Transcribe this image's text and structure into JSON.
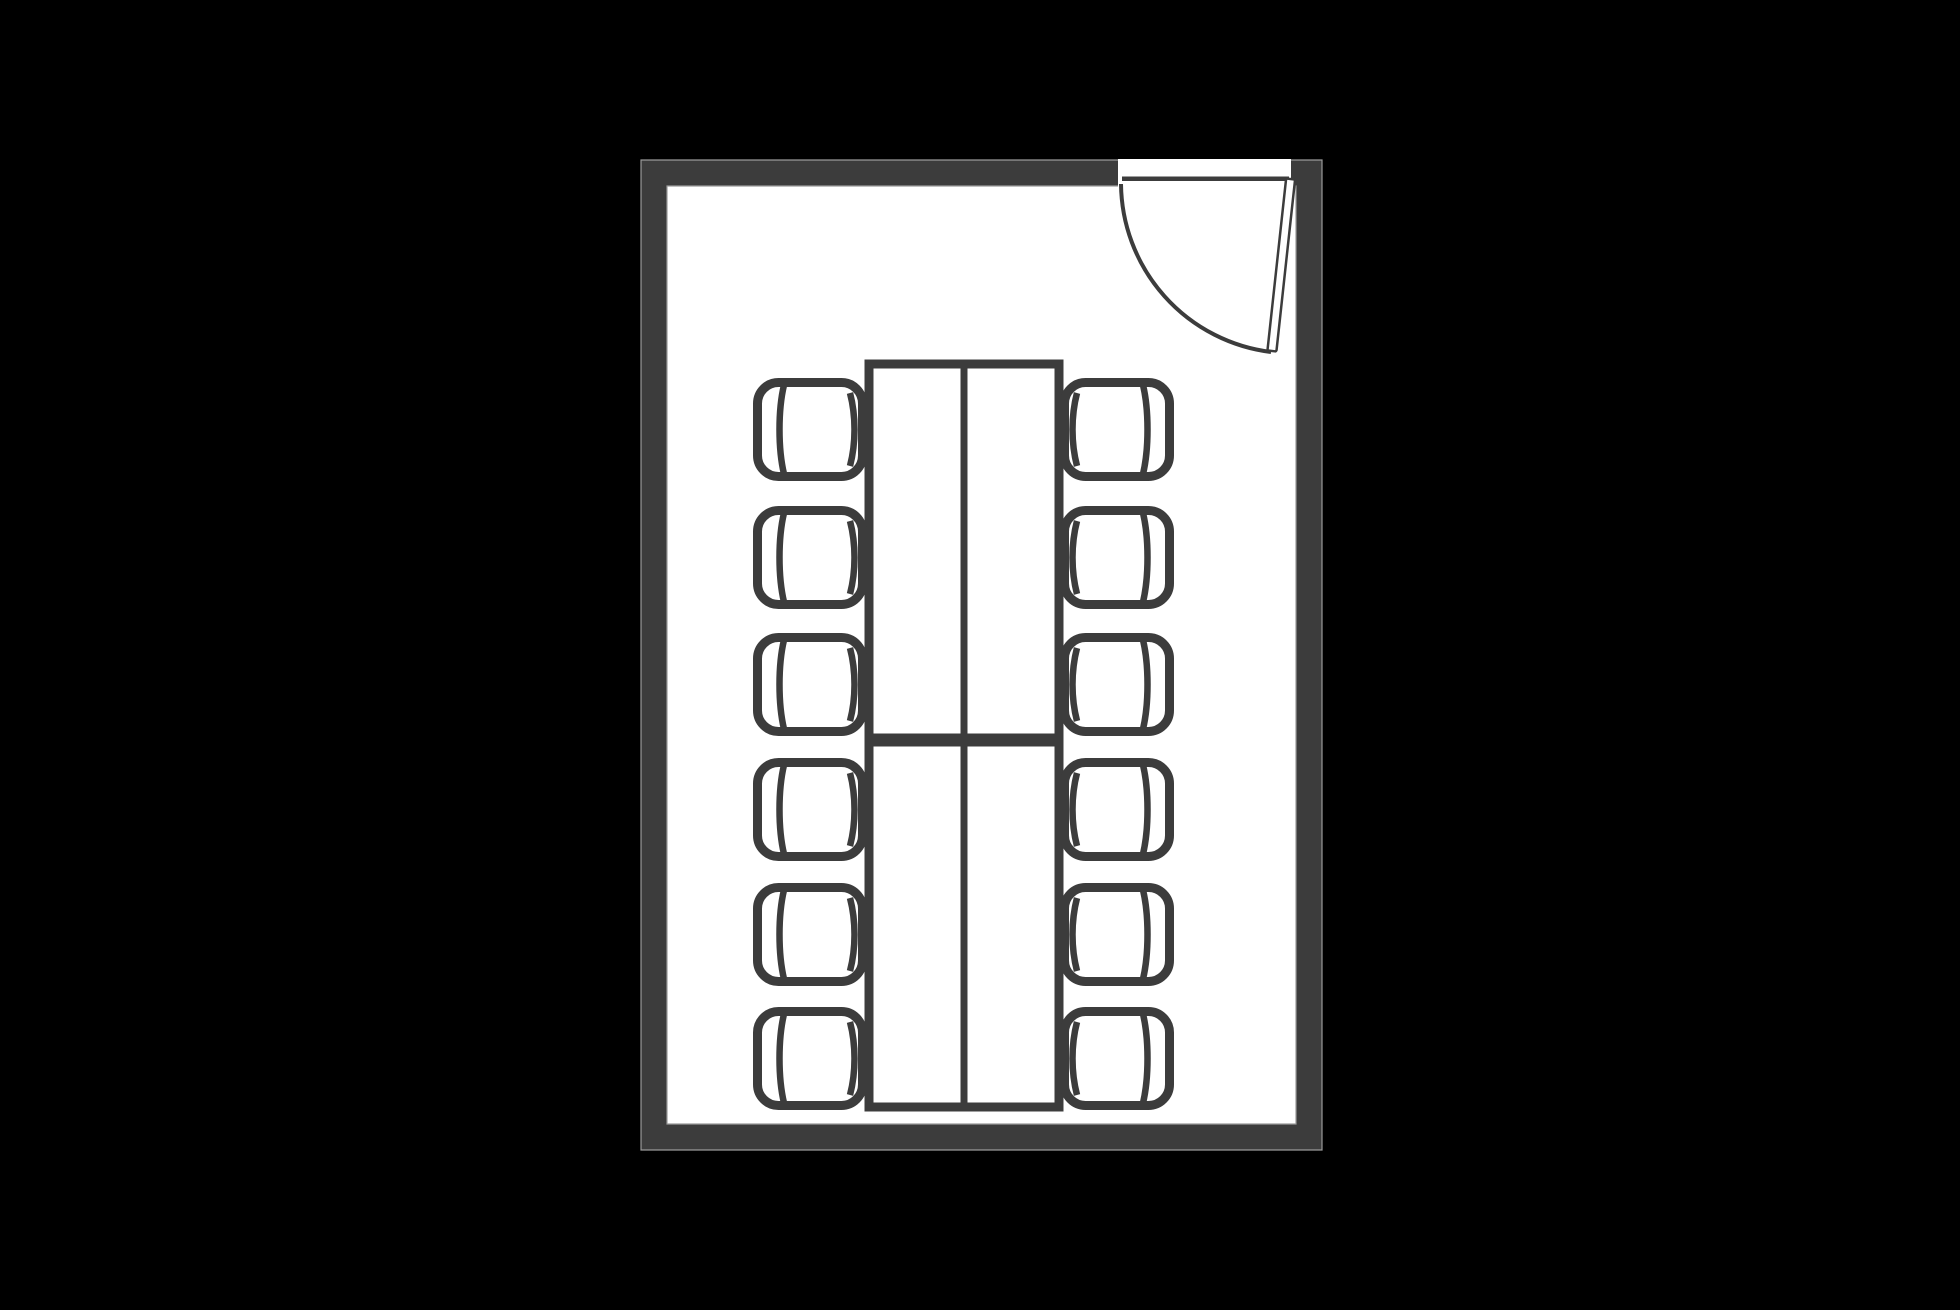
{
  "page": {
    "background_color": "#000000"
  },
  "diagram": {
    "type": "floor-plan",
    "subject": "conference-room-with-12-seat-table-arrangement",
    "colors": {
      "background": "#000000",
      "wall_fill": "#3c3c3c",
      "wall_edge_highlight": "#9a9a9a",
      "line": "#3c3c3c",
      "floor_fill": "#ffffff"
    },
    "room": {
      "outer_x": 641,
      "outer_y": 160,
      "outer_width": 681,
      "outer_height": 990,
      "wall_thickness": 26
    },
    "door": {
      "location": "top-right",
      "opening_start_x": 1118,
      "opening_end_x": 1291,
      "frame_line": {
        "x": 1122,
        "y": 176.5,
        "width": 167,
        "height": 4.5
      },
      "hinge_x": 1290.5,
      "hinge_y": 180,
      "leaf_length": 173,
      "leaf_width": 9,
      "leaf_angle_deg": 6.2,
      "leaf_stroke_width": 2.5,
      "swing_arc": {
        "start_x": 1121,
        "start_y": 184,
        "end_x": 1271,
        "end_y": 352,
        "radius": 171,
        "stroke_width": 4
      }
    },
    "tables": [
      {
        "id": "table-top",
        "x": 869,
        "y": 364,
        "width": 190,
        "height": 374
      },
      {
        "id": "table-bottom",
        "x": 869,
        "y": 742,
        "width": 190,
        "height": 365
      }
    ],
    "table_style": {
      "stroke_width": 9,
      "divider": "vertical-center",
      "divider_stroke_width": 7
    },
    "chairs": {
      "count": 12,
      "chair_width": 114,
      "chair_height": 103,
      "corner_radius": 21,
      "outline_stroke_width": 9,
      "detail_stroke_width": 6.5,
      "left_column_x": 753,
      "right_column_x": 1060,
      "row_top_y": [
        378,
        506,
        633,
        758,
        883,
        1007
      ],
      "left_column_facing": "right",
      "right_column_facing": "left"
    }
  }
}
